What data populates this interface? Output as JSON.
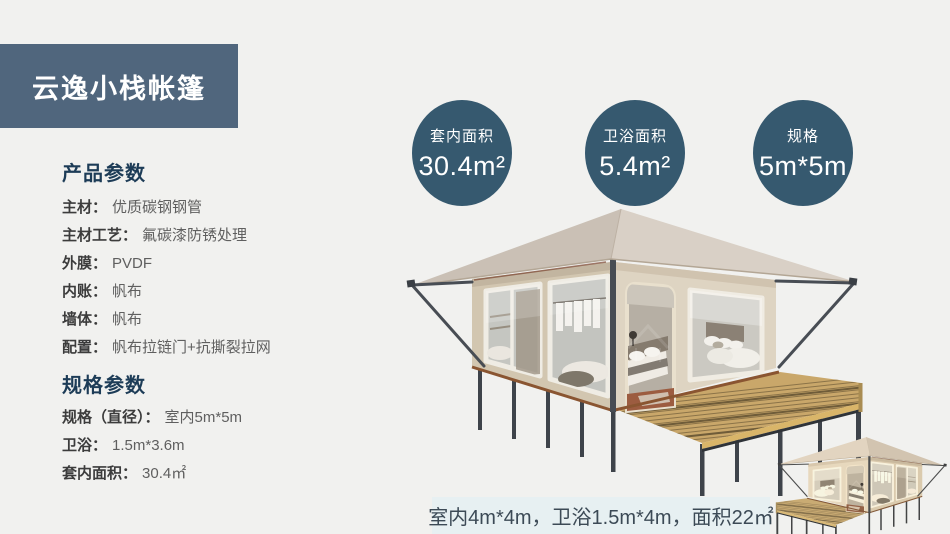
{
  "header": {
    "title": "云逸小栈帐篷"
  },
  "sidebar": {
    "product_section": {
      "heading": "产品参数",
      "items": [
        {
          "label": "主材：",
          "value": "优质碳钢钢管"
        },
        {
          "label": "主材工艺：",
          "value": "氟碳漆防锈处理"
        },
        {
          "label": "外膜：",
          "value": "PVDF"
        },
        {
          "label": "内账：",
          "value": "帆布"
        },
        {
          "label": "墙体：",
          "value": "帆布"
        },
        {
          "label": "配置：",
          "value": "帆布拉链门+抗撕裂拉网"
        }
      ]
    },
    "spec_section": {
      "heading": "规格参数",
      "items": [
        {
          "label": "规格（直径）：",
          "value": "室内5m*5m"
        },
        {
          "label": "卫浴：",
          "value": "1.5m*3.6m"
        },
        {
          "label": "套内面积：",
          "value": "30.4㎡"
        }
      ]
    }
  },
  "stats": [
    {
      "label": "套内面积",
      "value": "30.4m²"
    },
    {
      "label": "卫浴面积",
      "value": "5.4m²"
    },
    {
      "label": "规格",
      "value": "5m*5m"
    }
  ],
  "caption": {
    "text": "室内4m*4m，卫浴1.5m*4m，面积22㎡"
  },
  "colors": {
    "background": "#f1f1ef",
    "badge_bg": "#50667d",
    "stat_circle_bg": "#36596f",
    "heading_text": "#1d3c57",
    "caption_bg": "#e7f0f2",
    "caption_text": "#3c4a56",
    "tent_roof": "#d9d0c6",
    "tent_wall": "#ded4c2",
    "deck_wood": "#c9a76a"
  }
}
